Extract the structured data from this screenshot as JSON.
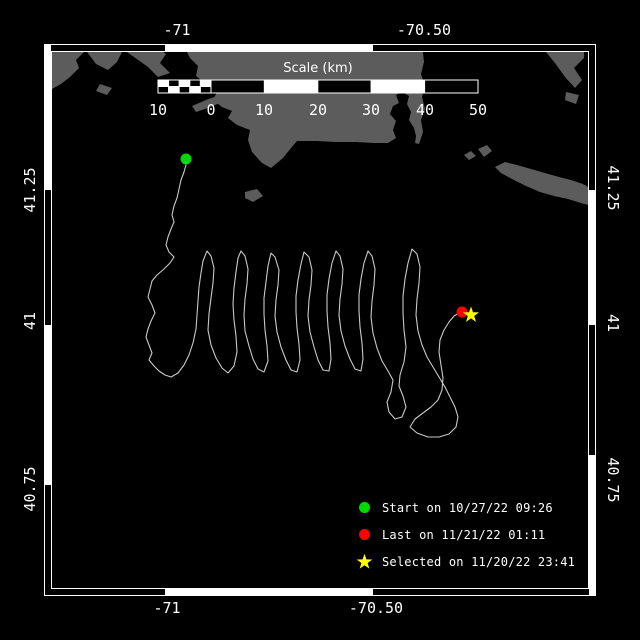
{
  "colors": {
    "background": "#000000",
    "land": "#5c5c5c",
    "track": "#c9c9c9",
    "frame": "#ffffff",
    "text": "#ffffff",
    "start": "#00d900",
    "last": "#ff0000",
    "selected": "#ffff00"
  },
  "axes": {
    "top": [
      {
        "label": "-71",
        "x": 177
      },
      {
        "label": "-70.50",
        "x": 424
      }
    ],
    "bottom": [
      {
        "label": "-71",
        "x": 167
      },
      {
        "label": "-70.50",
        "x": 376
      }
    ],
    "left": [
      {
        "label": "41.25",
        "y": 190
      },
      {
        "label": "41",
        "y": 321
      },
      {
        "label": "40.75",
        "y": 489
      }
    ],
    "right": [
      {
        "label": "41.25",
        "y": 188
      },
      {
        "label": "41",
        "y": 323
      },
      {
        "label": "40.75",
        "y": 480
      }
    ]
  },
  "scalebar": {
    "title": "Scale (km)",
    "title_x": 318,
    "title_y": 61,
    "bar": {
      "x0": 158,
      "x1": 478,
      "y0": 80,
      "y1": 93,
      "zero_x": 211,
      "left_subdivisions": 5,
      "right_cells": 5
    },
    "ticks": [
      {
        "label": "10",
        "x": 158
      },
      {
        "label": "0",
        "x": 211
      },
      {
        "label": "10",
        "x": 264
      },
      {
        "label": "20",
        "x": 318
      },
      {
        "label": "30",
        "x": 371
      },
      {
        "label": "40",
        "x": 425
      },
      {
        "label": "50",
        "x": 478
      }
    ],
    "tick_label_y": 101
  },
  "legend": {
    "x_marker": 356,
    "row_centers": [
      508,
      535,
      562
    ],
    "items": [
      {
        "marker": "start-dot",
        "label": "Start on 10/27/22 09:26"
      },
      {
        "marker": "last-dot",
        "label": "Last on 11/21/22 01:11"
      },
      {
        "marker": "selected-star",
        "label": "Selected on 11/20/22 23:41"
      }
    ]
  },
  "map": {
    "frame": {
      "outer": [
        44,
        44,
        596,
        596
      ],
      "inner": [
        51,
        51,
        589,
        589
      ],
      "white_segments": {
        "top": [
          [
            165,
            373
          ]
        ],
        "bottom": [
          [
            165,
            373
          ]
        ],
        "left": [
          [
            44,
            190
          ],
          [
            325,
            485
          ]
        ],
        "right": [
          [
            190,
            325
          ],
          [
            455,
            596
          ]
        ]
      }
    },
    "markers": {
      "start": {
        "x": 186,
        "y": 159
      },
      "last": {
        "x": 462,
        "y": 312
      },
      "selected": {
        "x": 471,
        "y": 315
      }
    },
    "land": [
      [
        [
          44,
          44
        ],
        [
          82,
          44
        ],
        [
          84,
          52
        ],
        [
          76,
          60
        ],
        [
          79,
          68
        ],
        [
          70,
          77
        ],
        [
          61,
          84
        ],
        [
          52,
          89
        ],
        [
          44,
          92
        ]
      ],
      [
        [
          86,
          44
        ],
        [
          116,
          44
        ],
        [
          122,
          52
        ],
        [
          117,
          62
        ],
        [
          108,
          70
        ],
        [
          96,
          64
        ],
        [
          90,
          56
        ],
        [
          84,
          48
        ]
      ],
      [
        [
          122,
          44
        ],
        [
          152,
          44
        ],
        [
          166,
          54
        ],
        [
          160,
          63
        ],
        [
          170,
          73
        ],
        [
          158,
          77
        ],
        [
          148,
          67
        ],
        [
          134,
          57
        ],
        [
          124,
          50
        ]
      ],
      [
        [
          100,
          84
        ],
        [
          112,
          88
        ],
        [
          107,
          95
        ],
        [
          96,
          91
        ]
      ],
      [
        [
          192,
          106
        ],
        [
          206,
          100
        ],
        [
          220,
          95
        ],
        [
          234,
          90
        ],
        [
          241,
          88
        ],
        [
          236,
          97
        ],
        [
          222,
          102
        ],
        [
          208,
          108
        ],
        [
          196,
          112
        ]
      ],
      [
        [
          183,
          44
        ],
        [
          190,
          58
        ],
        [
          198,
          66
        ],
        [
          196,
          76
        ],
        [
          206,
          84
        ],
        [
          217,
          92
        ],
        [
          213,
          100
        ],
        [
          222,
          107
        ],
        [
          232,
          111
        ],
        [
          228,
          118
        ],
        [
          237,
          125
        ],
        [
          250,
          130
        ],
        [
          248,
          140
        ],
        [
          252,
          152
        ],
        [
          262,
          163
        ],
        [
          271,
          168
        ],
        [
          283,
          158
        ],
        [
          291,
          148
        ],
        [
          297,
          141
        ],
        [
          316,
          141
        ],
        [
          336,
          142
        ],
        [
          356,
          142
        ],
        [
          374,
          143
        ],
        [
          388,
          143
        ],
        [
          396,
          138
        ],
        [
          393,
          130
        ],
        [
          396,
          121
        ],
        [
          390,
          114
        ],
        [
          393,
          106
        ],
        [
          399,
          103
        ],
        [
          396,
          95
        ],
        [
          402,
          92
        ],
        [
          409,
          96
        ],
        [
          407,
          104
        ],
        [
          411,
          112
        ],
        [
          409,
          120
        ],
        [
          414,
          128
        ],
        [
          416,
          136
        ],
        [
          415,
          143
        ],
        [
          419,
          144
        ],
        [
          423,
          132
        ],
        [
          421,
          120
        ],
        [
          425,
          109
        ],
        [
          422,
          97
        ],
        [
          425,
          86
        ],
        [
          421,
          74
        ],
        [
          424,
          62
        ],
        [
          422,
          44
        ]
      ],
      [
        [
          245,
          192
        ],
        [
          257,
          189
        ],
        [
          263,
          196
        ],
        [
          253,
          202
        ],
        [
          245,
          198
        ]
      ],
      [
        [
          464,
          155
        ],
        [
          471,
          151
        ],
        [
          476,
          156
        ],
        [
          469,
          160
        ]
      ],
      [
        [
          478,
          149
        ],
        [
          487,
          145
        ],
        [
          492,
          151
        ],
        [
          484,
          157
        ]
      ],
      [
        [
          495,
          167
        ],
        [
          505,
          162
        ],
        [
          517,
          165
        ],
        [
          531,
          169
        ],
        [
          545,
          173
        ],
        [
          559,
          177
        ],
        [
          571,
          180
        ],
        [
          583,
          184
        ],
        [
          592,
          189
        ],
        [
          596,
          191
        ],
        [
          596,
          207
        ],
        [
          581,
          203
        ],
        [
          568,
          199
        ],
        [
          554,
          196
        ],
        [
          540,
          192
        ],
        [
          526,
          186
        ],
        [
          512,
          179
        ],
        [
          501,
          173
        ]
      ],
      [
        [
          545,
          44
        ],
        [
          584,
          44
        ],
        [
          584,
          58
        ],
        [
          574,
          68
        ],
        [
          582,
          80
        ],
        [
          575,
          88
        ],
        [
          565,
          77
        ],
        [
          555,
          63
        ],
        [
          546,
          52
        ]
      ],
      [
        [
          566,
          92
        ],
        [
          579,
          95
        ],
        [
          576,
          104
        ],
        [
          565,
          100
        ]
      ]
    ],
    "track": [
      [
        186,
        165
      ],
      [
        184,
        172
      ],
      [
        181,
        180
      ],
      [
        179,
        189
      ],
      [
        177,
        198
      ],
      [
        174,
        206
      ],
      [
        172,
        215
      ],
      [
        174,
        222
      ],
      [
        171,
        229
      ],
      [
        168,
        237
      ],
      [
        166,
        245
      ],
      [
        169,
        252
      ],
      [
        174,
        257
      ],
      [
        170,
        263
      ],
      [
        164,
        269
      ],
      [
        157,
        275
      ],
      [
        152,
        281
      ],
      [
        150,
        289
      ],
      [
        148,
        297
      ],
      [
        152,
        305
      ],
      [
        155,
        313
      ],
      [
        151,
        321
      ],
      [
        148,
        329
      ],
      [
        146,
        337
      ],
      [
        149,
        345
      ],
      [
        152,
        353
      ],
      [
        149,
        360
      ],
      [
        154,
        366
      ],
      [
        159,
        371
      ],
      [
        165,
        375
      ],
      [
        171,
        377
      ],
      [
        178,
        373
      ],
      [
        184,
        365
      ],
      [
        189,
        355
      ],
      [
        193,
        343
      ],
      [
        196,
        329
      ],
      [
        197,
        315
      ],
      [
        198,
        301
      ],
      [
        199,
        287
      ],
      [
        201,
        273
      ],
      [
        203,
        261
      ],
      [
        207,
        251
      ],
      [
        211,
        256
      ],
      [
        214,
        268
      ],
      [
        213,
        283
      ],
      [
        211,
        298
      ],
      [
        209,
        314
      ],
      [
        208,
        330
      ],
      [
        211,
        345
      ],
      [
        216,
        358
      ],
      [
        222,
        368
      ],
      [
        228,
        373
      ],
      [
        234,
        366
      ],
      [
        237,
        352
      ],
      [
        236,
        336
      ],
      [
        234,
        320
      ],
      [
        233,
        304
      ],
      [
        234,
        288
      ],
      [
        236,
        272
      ],
      [
        238,
        258
      ],
      [
        241,
        251
      ],
      [
        245,
        256
      ],
      [
        248,
        269
      ],
      [
        247,
        284
      ],
      [
        245,
        299
      ],
      [
        244,
        315
      ],
      [
        245,
        331
      ],
      [
        249,
        346
      ],
      [
        253,
        359
      ],
      [
        258,
        369
      ],
      [
        264,
        372
      ],
      [
        268,
        361
      ],
      [
        267,
        346
      ],
      [
        265,
        330
      ],
      [
        264,
        314
      ],
      [
        264,
        298
      ],
      [
        266,
        282
      ],
      [
        268,
        266
      ],
      [
        271,
        253
      ],
      [
        275,
        257
      ],
      [
        279,
        270
      ],
      [
        278,
        285
      ],
      [
        276,
        300
      ],
      [
        275,
        316
      ],
      [
        277,
        332
      ],
      [
        281,
        347
      ],
      [
        286,
        360
      ],
      [
        291,
        370
      ],
      [
        297,
        372
      ],
      [
        300,
        360
      ],
      [
        299,
        344
      ],
      [
        297,
        328
      ],
      [
        296,
        312
      ],
      [
        296,
        296
      ],
      [
        298,
        280
      ],
      [
        301,
        264
      ],
      [
        304,
        252
      ],
      [
        309,
        257
      ],
      [
        312,
        270
      ],
      [
        311,
        285
      ],
      [
        309,
        300
      ],
      [
        308,
        316
      ],
      [
        310,
        332
      ],
      [
        314,
        347
      ],
      [
        318,
        360
      ],
      [
        323,
        370
      ],
      [
        329,
        371
      ],
      [
        331,
        359
      ],
      [
        330,
        343
      ],
      [
        328,
        327
      ],
      [
        327,
        311
      ],
      [
        327,
        295
      ],
      [
        329,
        279
      ],
      [
        332,
        263
      ],
      [
        336,
        251
      ],
      [
        340,
        256
      ],
      [
        343,
        269
      ],
      [
        342,
        284
      ],
      [
        340,
        299
      ],
      [
        339,
        315
      ],
      [
        341,
        331
      ],
      [
        345,
        346
      ],
      [
        350,
        359
      ],
      [
        355,
        369
      ],
      [
        361,
        371
      ],
      [
        363,
        359
      ],
      [
        362,
        343
      ],
      [
        360,
        327
      ],
      [
        359,
        311
      ],
      [
        359,
        295
      ],
      [
        361,
        279
      ],
      [
        364,
        263
      ],
      [
        368,
        251
      ],
      [
        372,
        256
      ],
      [
        375,
        269
      ],
      [
        374,
        285
      ],
      [
        372,
        301
      ],
      [
        371,
        317
      ],
      [
        373,
        333
      ],
      [
        377,
        348
      ],
      [
        382,
        361
      ],
      [
        388,
        371
      ],
      [
        393,
        380
      ],
      [
        391,
        392
      ],
      [
        387,
        402
      ],
      [
        389,
        412
      ],
      [
        395,
        419
      ],
      [
        402,
        417
      ],
      [
        406,
        407
      ],
      [
        403,
        396
      ],
      [
        399,
        386
      ],
      [
        400,
        375
      ],
      [
        404,
        362
      ],
      [
        406,
        347
      ],
      [
        404,
        330
      ],
      [
        403,
        313
      ],
      [
        403,
        296
      ],
      [
        405,
        279
      ],
      [
        408,
        263
      ],
      [
        412,
        249
      ],
      [
        417,
        254
      ],
      [
        420,
        267
      ],
      [
        419,
        283
      ],
      [
        417,
        299
      ],
      [
        416,
        315
      ],
      [
        418,
        331
      ],
      [
        422,
        345
      ],
      [
        427,
        357
      ],
      [
        433,
        367
      ],
      [
        439,
        377
      ],
      [
        445,
        387
      ],
      [
        450,
        397
      ],
      [
        455,
        407
      ],
      [
        458,
        417
      ],
      [
        456,
        427
      ],
      [
        449,
        434
      ],
      [
        439,
        437
      ],
      [
        428,
        437
      ],
      [
        417,
        433
      ],
      [
        410,
        427
      ],
      [
        415,
        419
      ],
      [
        423,
        413
      ],
      [
        431,
        407
      ],
      [
        438,
        400
      ],
      [
        442,
        390
      ],
      [
        443,
        378
      ],
      [
        441,
        365
      ],
      [
        439,
        352
      ],
      [
        440,
        340
      ],
      [
        444,
        330
      ],
      [
        449,
        322
      ],
      [
        454,
        316
      ],
      [
        459,
        313
      ],
      [
        462,
        312
      ]
    ]
  }
}
